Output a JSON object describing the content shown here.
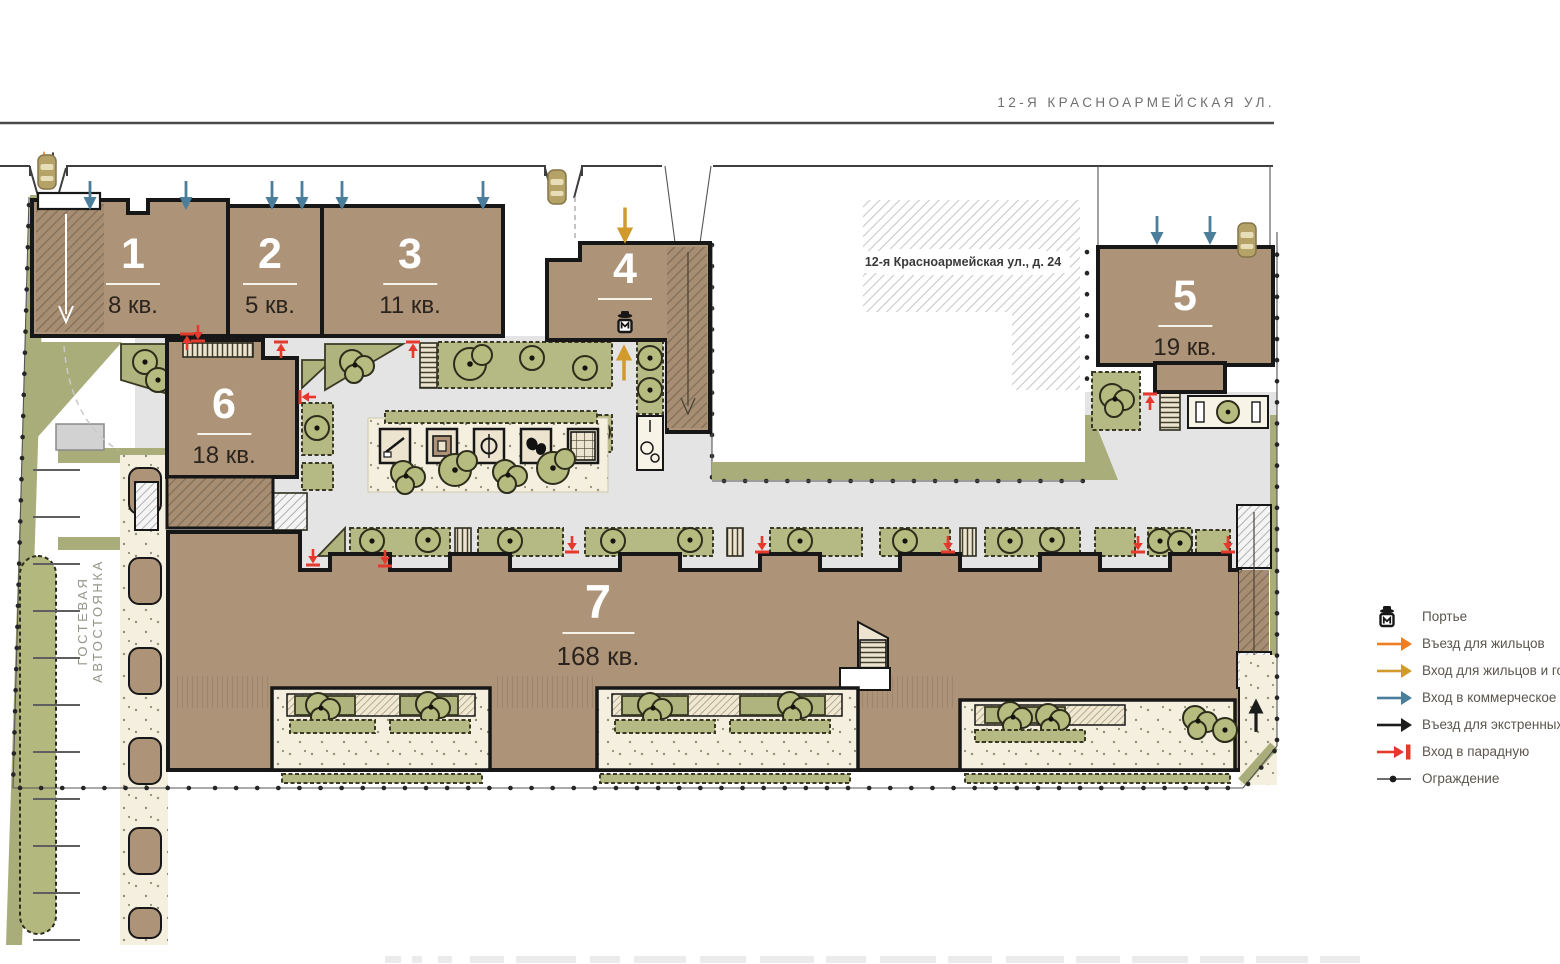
{
  "street": {
    "label": "12-Я КРАСНОАРМЕЙСКАЯ УЛ."
  },
  "neighbor": {
    "label": "12-я Красноармейская ул., д. 24"
  },
  "parking": {
    "label": "ГОСТЕВАЯ АВТОСТОЯНКА"
  },
  "buildings": [
    {
      "num": "1",
      "apts": "8 кв."
    },
    {
      "num": "2",
      "apts": "5 кв."
    },
    {
      "num": "3",
      "apts": "11 кв."
    },
    {
      "num": "4",
      "apts": ""
    },
    {
      "num": "5",
      "apts": "19 кв."
    },
    {
      "num": "6",
      "apts": "18 кв."
    },
    {
      "num": "7",
      "apts": "168 кв."
    }
  ],
  "legend": {
    "items": [
      {
        "icon": "concierge-icon",
        "label": "Портье",
        "color": "#1c1c1c"
      },
      {
        "icon": "resident-drive-arrow-icon",
        "label": "Въезд для жильцов",
        "color": "#ef7d23"
      },
      {
        "icon": "resident-guest-entry-arrow-icon",
        "label": "Вход для жильцов и госте",
        "color": "#d09a2c"
      },
      {
        "icon": "commercial-entry-arrow-icon",
        "label": "Вход в коммерческое пом",
        "color": "#4b7e9b"
      },
      {
        "icon": "emergency-drive-arrow-icon",
        "label": "Въезд для экстренных слу",
        "color": "#1c1c1c"
      },
      {
        "icon": "porch-entry-arrow-icon",
        "label": "Вход в парадную",
        "color": "#e6392e"
      },
      {
        "icon": "fence-icon",
        "label": "Ограждение",
        "color": "#1c1c1c"
      }
    ]
  },
  "colors": {
    "building": "#ad9378",
    "outline": "#171717",
    "courtyard": "#e4e4e5",
    "green": "#b5b984",
    "gravel": "#f4efdf",
    "resident_drive": "#ef7d23",
    "guest_entry": "#d09a2c",
    "commercial_entry": "#4b7e9b",
    "emergency": "#1c1c1c",
    "porch_entry": "#e6392e"
  }
}
